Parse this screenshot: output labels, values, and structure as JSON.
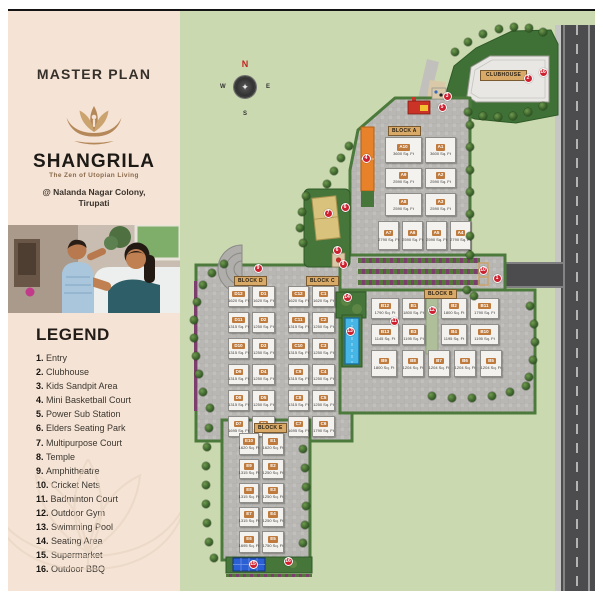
{
  "left_panel": {
    "title": "MASTER PLAN",
    "brand": {
      "name": "SHANGRILA",
      "tagline": "The Zen of Utopian Living",
      "address_line1": "@ Nalanda Nagar Colony,",
      "address_line2": "Tirupati"
    },
    "legend": {
      "heading": "LEGEND",
      "items": [
        {
          "num": "1",
          "label": "Entry"
        },
        {
          "num": "2",
          "label": "Clubhouse"
        },
        {
          "num": "3",
          "label": "Kids Sandpit Area"
        },
        {
          "num": "4",
          "label": "Mini Basketball Court"
        },
        {
          "num": "5",
          "label": "Power Sub Station"
        },
        {
          "num": "6",
          "label": "Elders Seating Park"
        },
        {
          "num": "7",
          "label": "Multipurpose Court"
        },
        {
          "num": "8",
          "label": "Temple"
        },
        {
          "num": "9",
          "label": "Amphitheatre"
        },
        {
          "num": "10",
          "label": "Cricket Nets"
        },
        {
          "num": "11",
          "label": "Badminton Court"
        },
        {
          "num": "12",
          "label": "Outdoor Gym"
        },
        {
          "num": "13",
          "label": "Swimming Pool"
        },
        {
          "num": "14",
          "label": "Seating Area"
        },
        {
          "num": "15",
          "label": "Supermarket"
        },
        {
          "num": "16",
          "label": "Outdoor BBQ"
        }
      ]
    }
  },
  "map": {
    "compass": {
      "n": "N",
      "e": "E",
      "s": "S",
      "w": "W"
    },
    "clubhouse_label": "CLUBHOUSE",
    "colors": {
      "grass": "#cbd9b1",
      "lawn": "#3f7136",
      "paving": "#b9b7b3",
      "road": "#4c4c4e",
      "marker": "#ce2130",
      "unit_chip": "#bf7b3e",
      "block_chip": "#d8a967",
      "pool": "#45b6e6",
      "court_orange": "#e8822a",
      "panel": "#f5e3d5",
      "gold": "#b5885a"
    },
    "blocks": [
      {
        "name": "BLOCK A",
        "chip": [
          208,
          115
        ],
        "units": [
          {
            "id": "A10",
            "sqft": "3600 Sq. Ft",
            "r": [
              205,
              126,
              37,
              26
            ]
          },
          {
            "id": "A1",
            "sqft": "3600 Sq. Ft",
            "r": [
              245,
              126,
              31,
              26
            ]
          },
          {
            "id": "A9",
            "sqft": "2590 Sq. Ft",
            "r": [
              205,
              157,
              37,
              20
            ]
          },
          {
            "id": "A2",
            "sqft": "2590 Sq. Ft",
            "r": [
              245,
              157,
              31,
              20
            ]
          },
          {
            "id": "A8",
            "sqft": "2590 Sq. Ft",
            "r": [
              205,
              182,
              37,
              23
            ]
          },
          {
            "id": "A3",
            "sqft": "2590 Sq. Ft",
            "r": [
              245,
              182,
              31,
              23
            ]
          },
          {
            "id": "A7",
            "sqft": "2790 Sq. Ft",
            "r": [
              198,
              210,
              21,
              29
            ]
          },
          {
            "id": "A6",
            "sqft": "2590 Sq. Ft",
            "r": [
              222,
              210,
              21,
              29
            ]
          },
          {
            "id": "A5",
            "sqft": "2590 Sq. Ft",
            "r": [
              246,
              210,
              21,
              29
            ]
          },
          {
            "id": "A4",
            "sqft": "2790 Sq. Ft",
            "r": [
              270,
              210,
              21,
              29
            ]
          }
        ]
      },
      {
        "name": "BLOCK D",
        "chip": [
          54,
          265
        ],
        "units": [
          {
            "id": "D12",
            "sqft": "1620 Sq. Ft",
            "r": [
              48,
              275,
              21,
              21
            ]
          },
          {
            "id": "D1",
            "sqft": "1620 Sq. Ft",
            "r": [
              72,
              275,
              23,
              21
            ]
          },
          {
            "id": "D11",
            "sqft": "1315 Sq. Ft",
            "r": [
              48,
              301,
              21,
              21
            ]
          },
          {
            "id": "D2",
            "sqft": "1250 Sq. Ft",
            "r": [
              72,
              301,
              23,
              21
            ]
          },
          {
            "id": "D10",
            "sqft": "1315 Sq. Ft",
            "r": [
              48,
              327,
              21,
              21
            ]
          },
          {
            "id": "D3",
            "sqft": "1250 Sq. Ft",
            "r": [
              72,
              327,
              23,
              21
            ]
          },
          {
            "id": "D9",
            "sqft": "1315 Sq. Ft",
            "r": [
              48,
              353,
              21,
              21
            ]
          },
          {
            "id": "D4",
            "sqft": "1250 Sq. Ft",
            "r": [
              72,
              353,
              23,
              21
            ]
          },
          {
            "id": "D8",
            "sqft": "1315 Sq. Ft",
            "r": [
              48,
              379,
              21,
              21
            ]
          },
          {
            "id": "D5",
            "sqft": "1250 Sq. Ft",
            "r": [
              72,
              379,
              23,
              21
            ]
          },
          {
            "id": "D7",
            "sqft": "1695 Sq. Ft",
            "r": [
              48,
              405,
              21,
              21
            ]
          },
          {
            "id": "D6",
            "sqft": "1790 Sq. Ft",
            "r": [
              72,
              405,
              23,
              21
            ]
          }
        ]
      },
      {
        "name": "BLOCK C",
        "chip": [
          126,
          265
        ],
        "units": [
          {
            "id": "C12",
            "sqft": "1620 Sq. Ft",
            "r": [
              108,
              275,
              21,
              21
            ]
          },
          {
            "id": "C1",
            "sqft": "1620 Sq. Ft",
            "r": [
              132,
              275,
              23,
              21
            ]
          },
          {
            "id": "C11",
            "sqft": "1315 Sq. Ft",
            "r": [
              108,
              301,
              21,
              21
            ]
          },
          {
            "id": "C2",
            "sqft": "1250 Sq. Ft",
            "r": [
              132,
              301,
              23,
              21
            ]
          },
          {
            "id": "C10",
            "sqft": "1315 Sq. Ft",
            "r": [
              108,
              327,
              21,
              21
            ]
          },
          {
            "id": "C3",
            "sqft": "1250 Sq. Ft",
            "r": [
              132,
              327,
              23,
              21
            ]
          },
          {
            "id": "C9",
            "sqft": "1315 Sq. Ft",
            "r": [
              108,
              353,
              21,
              21
            ]
          },
          {
            "id": "C4",
            "sqft": "1250 Sq. Ft",
            "r": [
              132,
              353,
              23,
              21
            ]
          },
          {
            "id": "C8",
            "sqft": "1315 Sq. Ft",
            "r": [
              108,
              379,
              21,
              21
            ]
          },
          {
            "id": "C5",
            "sqft": "1250 Sq. Ft",
            "r": [
              132,
              379,
              23,
              21
            ]
          },
          {
            "id": "C7",
            "sqft": "1695 Sq. Ft",
            "r": [
              108,
              405,
              21,
              21
            ]
          },
          {
            "id": "C6",
            "sqft": "1790 Sq. Ft",
            "r": [
              132,
              405,
              23,
              21
            ]
          }
        ]
      },
      {
        "name": "BLOCK B",
        "chip": [
          244,
          278
        ],
        "units": [
          {
            "id": "B12",
            "sqft": "1790 Sq. Ft",
            "r": [
              191,
              287,
              28,
              21
            ]
          },
          {
            "id": "B1",
            "sqft": "1800 Sq. Ft",
            "r": [
              222,
              287,
              23,
              21
            ]
          },
          {
            "id": "B2",
            "sqft": "1800 Sq. Ft",
            "r": [
              261,
              287,
              26,
              21
            ]
          },
          {
            "id": "B11",
            "sqft": "1790 Sq. Ft",
            "r": [
              290,
              287,
              29,
              21
            ]
          },
          {
            "id": "B13",
            "sqft": "1145 Sq. Ft",
            "r": [
              191,
              313,
              28,
              21
            ]
          },
          {
            "id": "B3",
            "sqft": "1195 Sq. Ft",
            "r": [
              222,
              313,
              23,
              21
            ]
          },
          {
            "id": "B4",
            "sqft": "1195 Sq. Ft",
            "r": [
              261,
              313,
              26,
              21
            ]
          },
          {
            "id": "B10",
            "sqft": "1195 Sq. Ft",
            "r": [
              290,
              313,
              29,
              21
            ]
          },
          {
            "id": "B9",
            "sqft": "1800 Sq. Ft",
            "r": [
              191,
              339,
              26,
              27
            ]
          },
          {
            "id": "B8",
            "sqft": "1204 Sq. Ft",
            "r": [
              222,
              339,
              22,
              27
            ]
          },
          {
            "id": "B7",
            "sqft": "1204 Sq. Ft",
            "r": [
              248,
              339,
              22,
              27
            ]
          },
          {
            "id": "B6",
            "sqft": "1204 Sq. Ft",
            "r": [
              274,
              339,
              22,
              27
            ]
          },
          {
            "id": "B5",
            "sqft": "1204 Sq. Ft",
            "r": [
              300,
              339,
              22,
              27
            ]
          }
        ]
      },
      {
        "name": "BLOCK E",
        "chip": [
          74,
          412
        ],
        "units": [
          {
            "id": "E10",
            "sqft": "1620 Sq. Ft",
            "r": [
              59,
              422,
              20,
              22
            ]
          },
          {
            "id": "E1",
            "sqft": "1620 Sq. Ft",
            "r": [
              82,
              422,
              22,
              22
            ]
          },
          {
            "id": "E9",
            "sqft": "1315 Sq. Ft",
            "r": [
              59,
              448,
              20,
              20
            ]
          },
          {
            "id": "E2",
            "sqft": "1250 Sq. Ft",
            "r": [
              82,
              448,
              22,
              20
            ]
          },
          {
            "id": "E8",
            "sqft": "1315 Sq. Ft",
            "r": [
              59,
              472,
              20,
              20
            ]
          },
          {
            "id": "E3",
            "sqft": "1250 Sq. Ft",
            "r": [
              82,
              472,
              22,
              20
            ]
          },
          {
            "id": "E7",
            "sqft": "1315 Sq. Ft",
            "r": [
              59,
              496,
              20,
              20
            ]
          },
          {
            "id": "E4",
            "sqft": "1250 Sq. Ft",
            "r": [
              82,
              496,
              22,
              20
            ]
          },
          {
            "id": "E6",
            "sqft": "1695 Sq. Ft",
            "r": [
              59,
              520,
              20,
              22
            ]
          },
          {
            "id": "E5",
            "sqft": "1750 Sq. Ft",
            "r": [
              82,
              520,
              22,
              22
            ]
          }
        ]
      }
    ],
    "markers": [
      {
        "n": "1",
        "x": 317,
        "y": 267
      },
      {
        "n": "2",
        "x": 348,
        "y": 67
      },
      {
        "n": "3",
        "x": 267,
        "y": 85
      },
      {
        "n": "4",
        "x": 186,
        "y": 147
      },
      {
        "n": "5",
        "x": 262,
        "y": 96
      },
      {
        "n": "6",
        "x": 165,
        "y": 196
      },
      {
        "n": "6",
        "x": 157,
        "y": 239
      },
      {
        "n": "7",
        "x": 148,
        "y": 202
      },
      {
        "n": "8",
        "x": 163,
        "y": 253
      },
      {
        "n": "9",
        "x": 78,
        "y": 257
      },
      {
        "n": "10",
        "x": 303,
        "y": 259
      },
      {
        "n": "11",
        "x": 214,
        "y": 310
      },
      {
        "n": "12",
        "x": 252,
        "y": 299
      },
      {
        "n": "13",
        "x": 170,
        "y": 320
      },
      {
        "n": "14",
        "x": 167,
        "y": 286
      },
      {
        "n": "15",
        "x": 73,
        "y": 553
      },
      {
        "n": "16",
        "x": 108,
        "y": 550
      },
      {
        "n": "16",
        "x": 363,
        "y": 61
      }
    ],
    "trees": [
      [
        275,
        41
      ],
      [
        288,
        31
      ],
      [
        303,
        23
      ],
      [
        319,
        18
      ],
      [
        334,
        16
      ],
      [
        349,
        17
      ],
      [
        363,
        21
      ],
      [
        288,
        101
      ],
      [
        303,
        105
      ],
      [
        318,
        106
      ],
      [
        333,
        105
      ],
      [
        348,
        101
      ],
      [
        363,
        95
      ],
      [
        169,
        135
      ],
      [
        161,
        147
      ],
      [
        154,
        160
      ],
      [
        147,
        173
      ],
      [
        290,
        114
      ],
      [
        290,
        136
      ],
      [
        290,
        159
      ],
      [
        290,
        181
      ],
      [
        290,
        203
      ],
      [
        290,
        225
      ],
      [
        290,
        244
      ],
      [
        23,
        274
      ],
      [
        17,
        291
      ],
      [
        14,
        309
      ],
      [
        14,
        327
      ],
      [
        16,
        345
      ],
      [
        19,
        363
      ],
      [
        23,
        381
      ],
      [
        30,
        397
      ],
      [
        32,
        262
      ],
      [
        44,
        253
      ],
      [
        29,
        417
      ],
      [
        27,
        436
      ],
      [
        26,
        455
      ],
      [
        26,
        474
      ],
      [
        26,
        493
      ],
      [
        27,
        512
      ],
      [
        29,
        531
      ],
      [
        34,
        547
      ],
      [
        123,
        438
      ],
      [
        125,
        457
      ],
      [
        126,
        476
      ],
      [
        126,
        495
      ],
      [
        125,
        514
      ],
      [
        123,
        532
      ],
      [
        252,
        385
      ],
      [
        272,
        387
      ],
      [
        292,
        387
      ],
      [
        312,
        385
      ],
      [
        330,
        381
      ],
      [
        346,
        375
      ],
      [
        350,
        295
      ],
      [
        354,
        313
      ],
      [
        355,
        331
      ],
      [
        353,
        349
      ],
      [
        349,
        366
      ],
      [
        287,
        279
      ],
      [
        294,
        285
      ],
      [
        126,
        185
      ],
      [
        122,
        201
      ],
      [
        120,
        217
      ],
      [
        123,
        232
      ]
    ]
  }
}
